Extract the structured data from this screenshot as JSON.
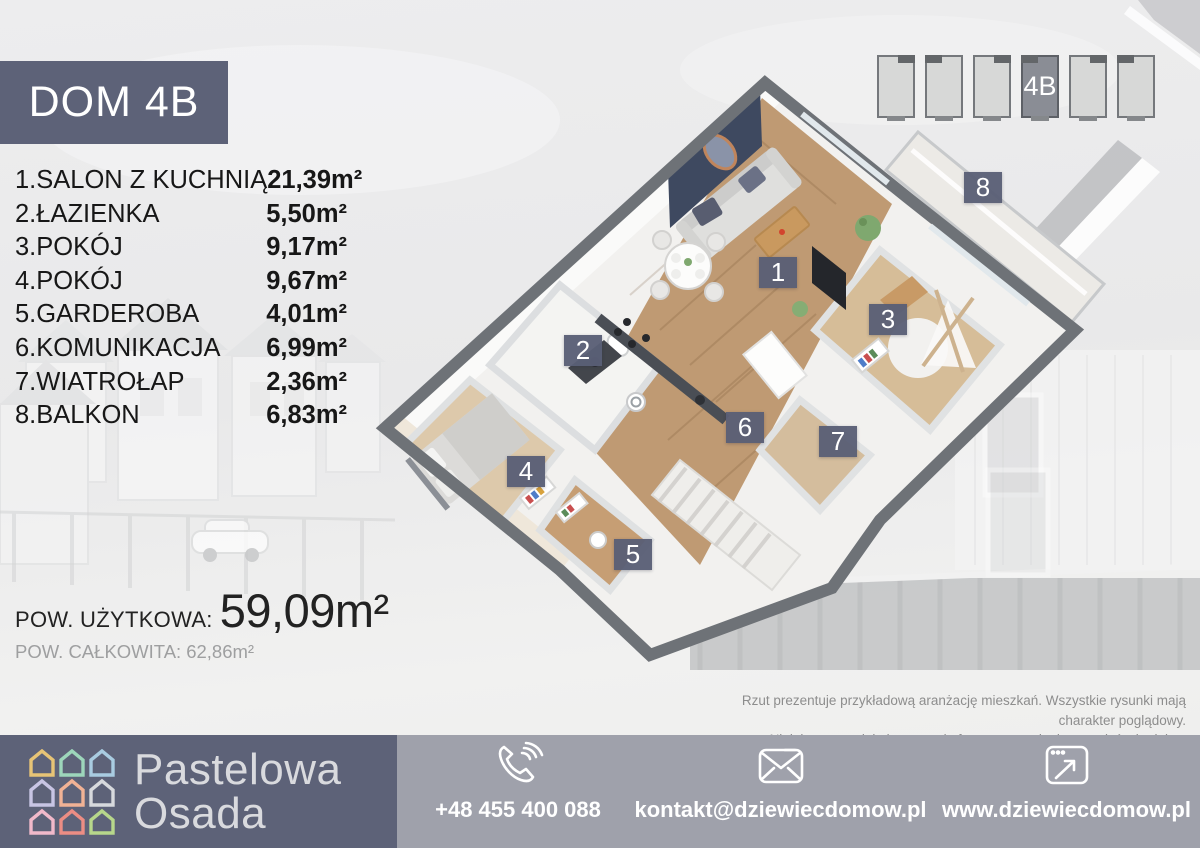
{
  "header": {
    "title": "DOM 4B"
  },
  "rooms": [
    {
      "number": "1",
      "name": "1.SALON Z KUCHNIĄ",
      "area": "21,39m²"
    },
    {
      "number": "2",
      "name": "2.ŁAZIENKA",
      "area": "5,50m²"
    },
    {
      "number": "3",
      "name": "3.POKÓJ",
      "area": "9,17m²"
    },
    {
      "number": "4",
      "name": "4.POKÓJ",
      "area": "9,67m²"
    },
    {
      "number": "5",
      "name": "5.GARDEROBA",
      "area": "4,01m²"
    },
    {
      "number": "6",
      "name": "6.KOMUNIKACJA",
      "area": "6,99m²"
    },
    {
      "number": "7",
      "name": "7.WIATROŁAP",
      "area": "2,36m²"
    },
    {
      "number": "8",
      "name": "8.BALKON",
      "area": "6,83m²"
    }
  ],
  "summary": {
    "usable_label": "POW. UŻYTKOWA:",
    "usable_value": "59,09m²",
    "total_label": "POW. CAŁKOWITA:",
    "total_value": "62,86m²"
  },
  "site_plan": {
    "selected_label": "4B"
  },
  "disclaimer": {
    "line1": "Rzut prezentuje przykładową aranżację mieszkań. Wszystkie rysunki mają charakter poglądowy.",
    "line2": "Niniejszy materiał nie stanowi oferty w rozumieniu przepisów kodeksu cywilnego."
  },
  "footer": {
    "brand_line1": "Pastelowa",
    "brand_line2": "Osada",
    "phone": "+48 455 400 088",
    "email": "kontakt@dziewiecdomow.pl",
    "website": "www.dziewiecdomow.pl"
  },
  "colors": {
    "accent": "#5d6278",
    "footer_gray": "#9fa1ab",
    "navy_wall": "#3e4960",
    "wood_floor": "#bf9a73",
    "logo_houses": [
      "#e7c476",
      "#9dd6bb",
      "#a9cce1",
      "#c8c5e4",
      "#f1b295",
      "#d7d9dd",
      "#f1b9ca",
      "#ec8d84",
      "#b7d78b"
    ]
  }
}
